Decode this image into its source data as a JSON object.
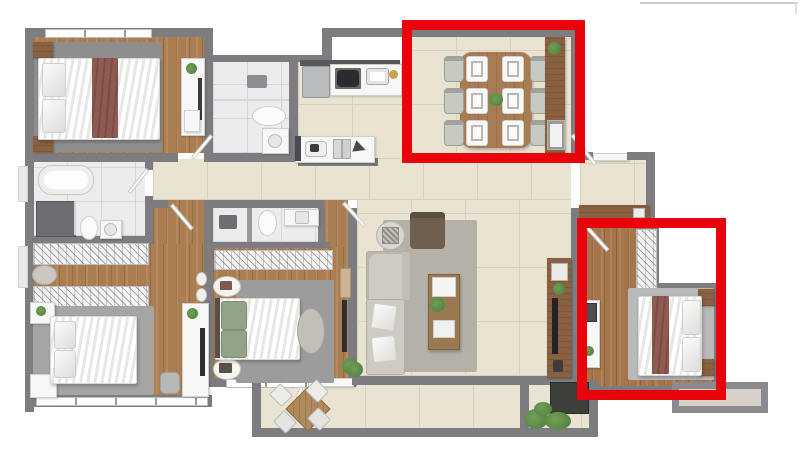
{
  "scene": {
    "kind": "apartment-floor-plan-render",
    "description": "Top-down 3D rendered floor plan of an apartment with two red highlight rectangles",
    "background": "#ffffff"
  },
  "colors": {
    "red": "#e9040b",
    "wall": "#7d7d81",
    "wallLight": "#98989c",
    "tile": "#e9e3d2",
    "tileLine": "#d9d1bc",
    "wood": "#ab7e52",
    "wood3": "#a5764b",
    "consoleWood": "#8a6140",
    "bathFloor": "#ececee",
    "maroon": "#8e5b53",
    "sage": "#93a389",
    "plant": "#4e7a42",
    "sofa": "#cfcbc2",
    "armchair": "#6e5f4e",
    "livingRug": "#b3b1a8",
    "chair": "#c6cabf",
    "ledge": "#d8d1ca"
  },
  "highlights": [
    {
      "id": "dining-highlight",
      "target": "dining-area",
      "shape": "rectangle",
      "color": "#e9040b"
    },
    {
      "id": "bedroom-highlight",
      "target": "bedroom-3",
      "shape": "rectangle",
      "color": "#e9040b"
    }
  ],
  "rooms": [
    {
      "name": "bedroom-1",
      "features": [
        "double-bed",
        "maroon-runner",
        "wardrobe",
        "nightstands"
      ]
    },
    {
      "name": "ensuite-bathroom-1",
      "features": [
        "shower",
        "toilet",
        "vanity"
      ]
    },
    {
      "name": "kitchen",
      "features": [
        "fridge",
        "cooktop-4-burners",
        "sink",
        "island-counter"
      ]
    },
    {
      "name": "dining-area",
      "features": [
        "table",
        "6-chairs",
        "6-place-settings",
        "sideboard",
        "plant"
      ]
    },
    {
      "name": "hallway",
      "features": []
    },
    {
      "name": "master-bathroom",
      "features": [
        "bathtub",
        "shower",
        "toilet",
        "sink"
      ]
    },
    {
      "name": "walk-in-closet",
      "features": [
        "two-shelving-rows",
        "pouf"
      ]
    },
    {
      "name": "master-bedroom",
      "features": [
        "double-bed",
        "tv-unit",
        "nightstands",
        "windows"
      ]
    },
    {
      "name": "bedroom-2",
      "features": [
        "double-bed-sage",
        "closet-shelf",
        "oval-pouf",
        "round-tables",
        "tv"
      ]
    },
    {
      "name": "bathroom-2",
      "features": [
        "shower",
        "toilet",
        "vanity"
      ]
    },
    {
      "name": "living-room",
      "features": [
        "sofa",
        "armchair",
        "coffee-table",
        "tv-console",
        "side-table"
      ]
    },
    {
      "name": "foyer",
      "features": [
        "entry-door",
        "shoe-console"
      ]
    },
    {
      "name": "bedroom-3",
      "features": [
        "double-bed",
        "maroon-runner",
        "closet",
        "desk",
        "nightstands"
      ]
    },
    {
      "name": "balcony",
      "features": [
        "bistro-table",
        "4-chairs",
        "planter",
        "sliding-door"
      ]
    }
  ],
  "dining": {
    "seats": 6,
    "place_settings": 6
  },
  "misc": {
    "top_right_artifact_line": true,
    "ac_ledge": true
  }
}
